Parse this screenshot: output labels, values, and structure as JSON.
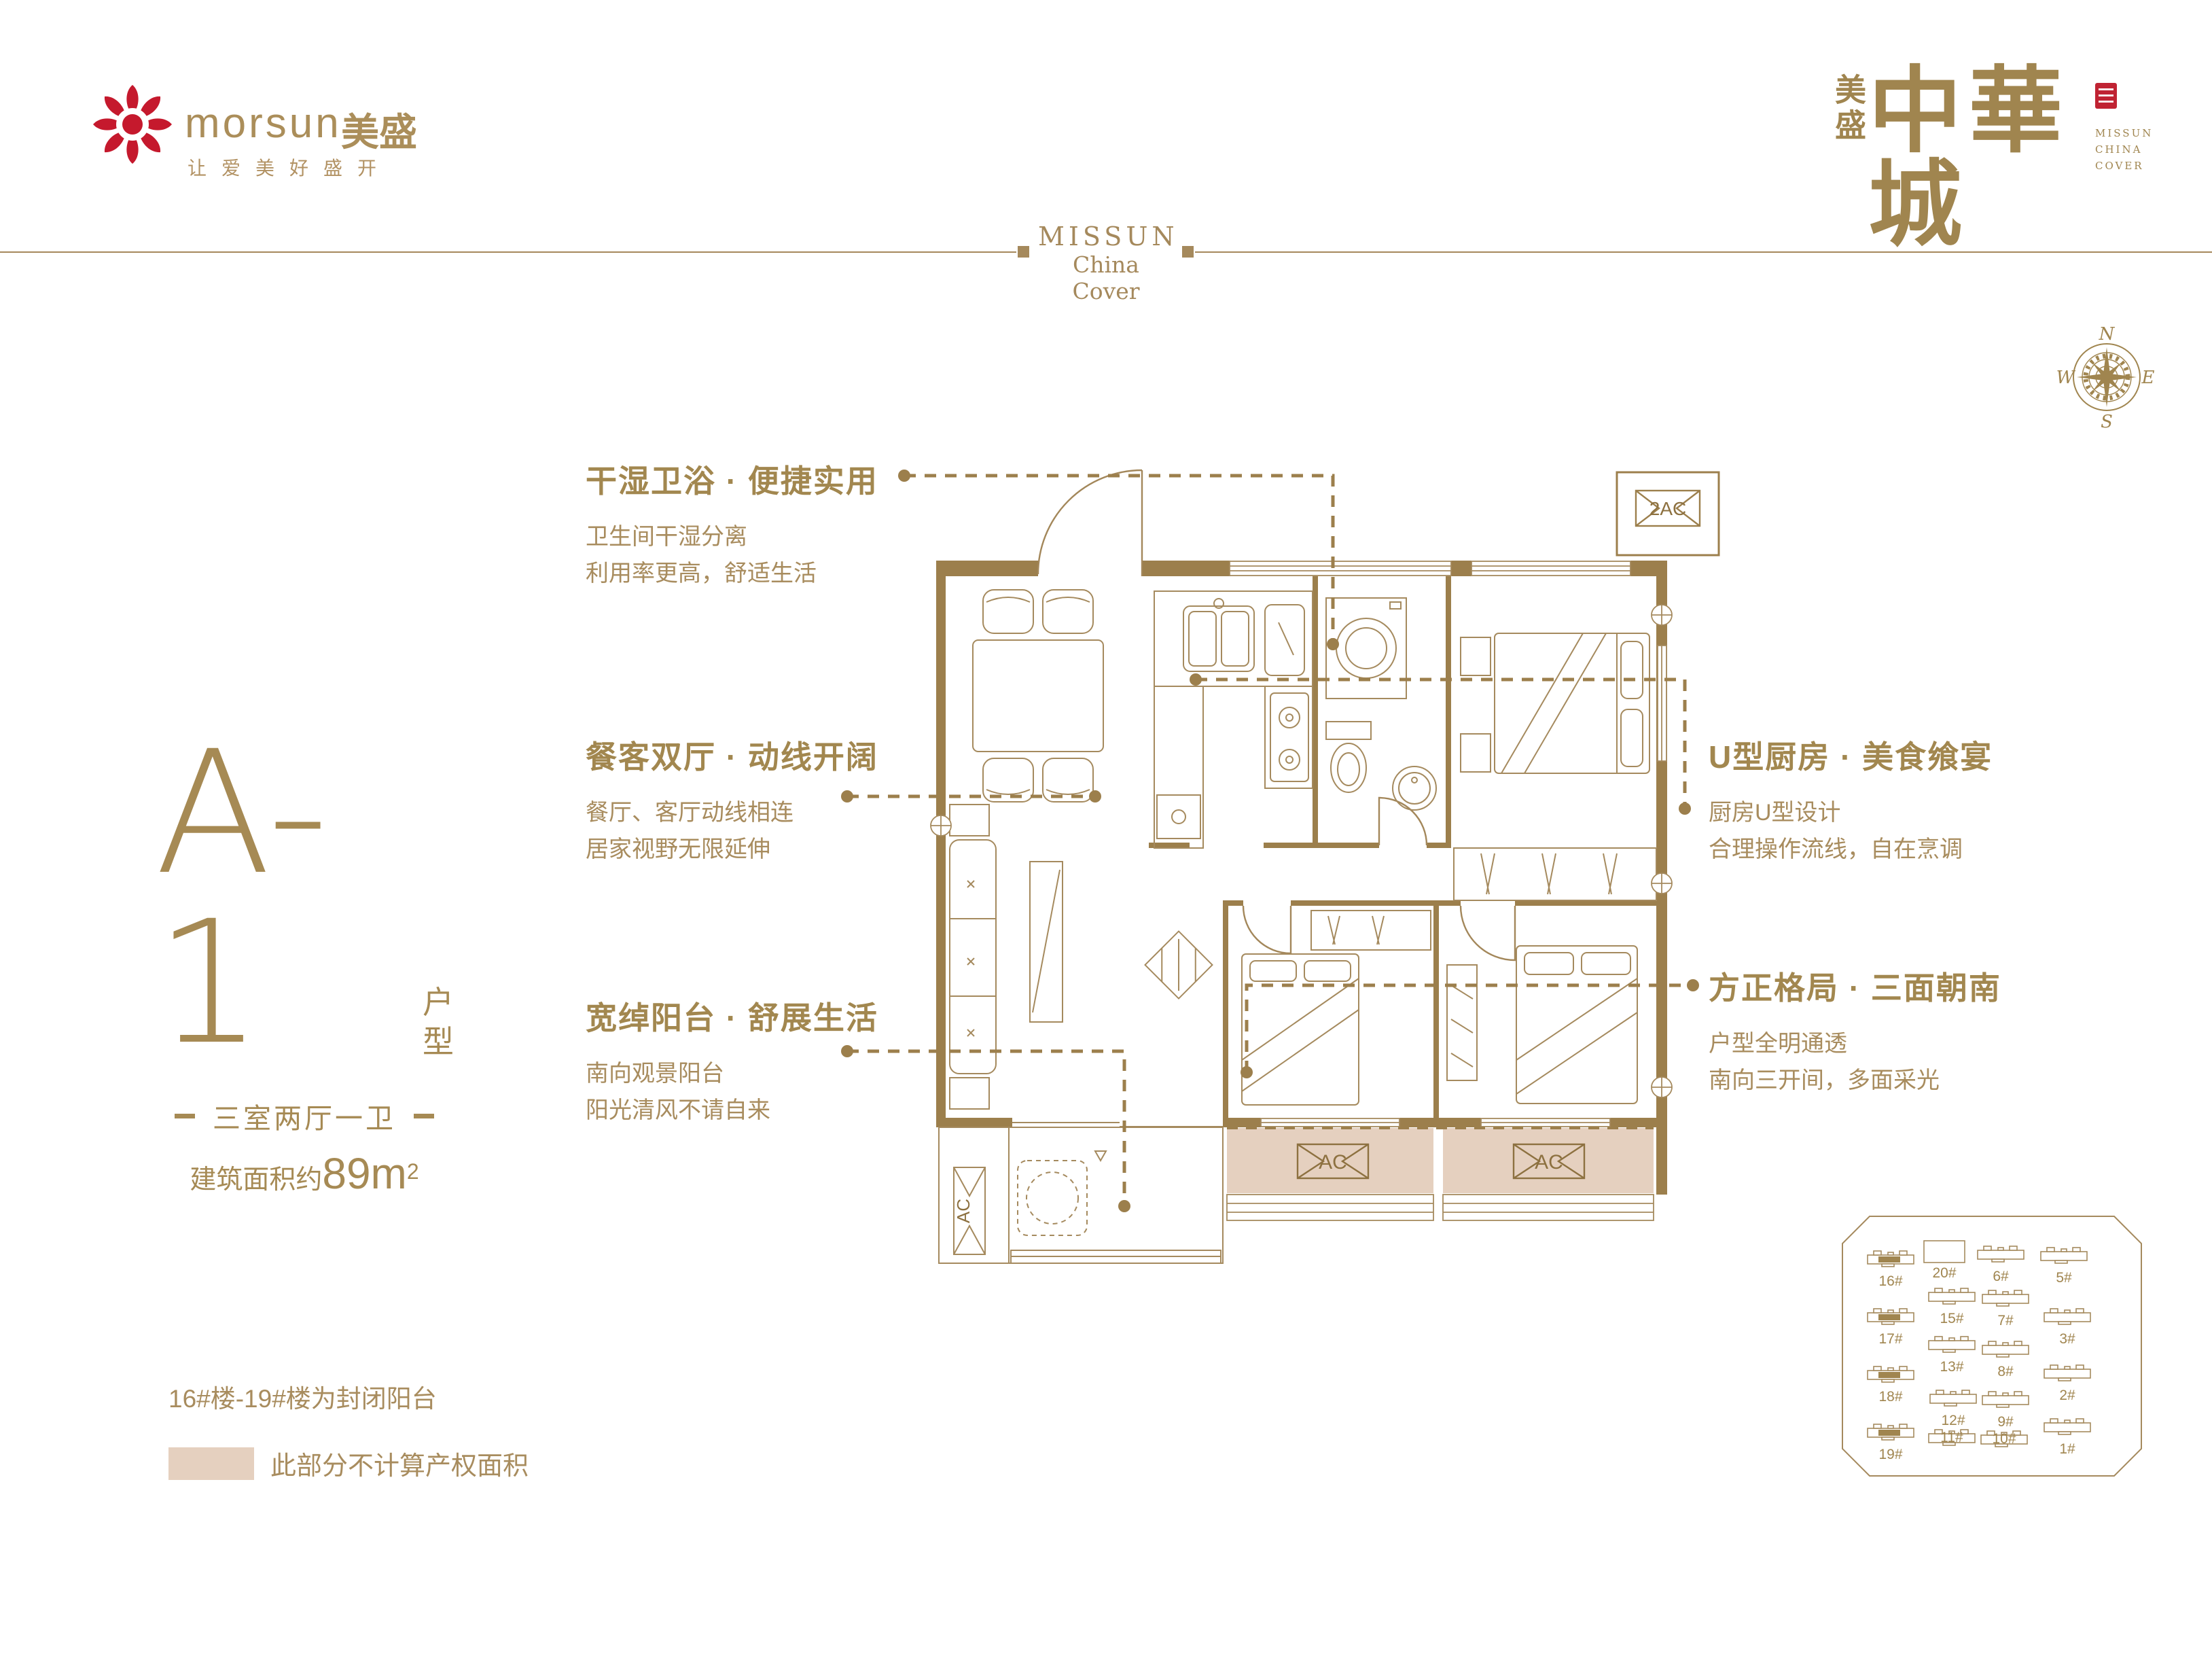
{
  "brand": {
    "logo_en": "morsun",
    "logo_cn": "美盛",
    "tagline": "让爱美好盛开",
    "red": "#c5192d",
    "gold": "#a0854f"
  },
  "project": {
    "name_prefix": "美盛",
    "name_main": "中華城",
    "sub_lines": {
      "l1": "MISSUN",
      "l2": "CHINA",
      "l3": "COVER"
    }
  },
  "divider": {
    "title": "MISSUN",
    "subtitle": "China Cover"
  },
  "unit": {
    "code": "A-1",
    "suffix_top": "户",
    "suffix_bottom": "型",
    "layout": "三室两厅一卫",
    "area_label": "建筑面积约",
    "area_value": "89m",
    "area_sup": "2"
  },
  "annotations": [
    {
      "title": "干湿卫浴 · 便捷实用",
      "line1": "卫生间干湿分离",
      "line2": "利用率更高，舒适生活"
    },
    {
      "title": "餐客双厅 · 动线开阔",
      "line1": "餐厅、客厅动线相连",
      "line2": "居家视野无限延伸"
    },
    {
      "title": "宽绰阳台 · 舒展生活",
      "line1": "南向观景阳台",
      "line2": "阳光清风不请自来"
    },
    {
      "title": "U型厨房 · 美食飨宴",
      "line1": "厨房U型设计",
      "line2": "合理操作流线，自在烹调"
    },
    {
      "title": "方正格局 · 三面朝南",
      "line1": "户型全明通透",
      "line2": "南向三开间，多面采光"
    }
  ],
  "notes": {
    "note1": "16#楼-19#楼为封闭阳台",
    "legend_label": "此部分不计算产权面积",
    "legend_color": "#e5d0bf"
  },
  "floor_plan": {
    "labels": {
      "ac": "AC",
      "ac2": "2AC"
    }
  },
  "compass": {
    "n": "N",
    "e": "E",
    "s": "S",
    "w": "W"
  },
  "site_plan": {
    "buildings": [
      {
        "label": "16#"
      },
      {
        "label": "20#"
      },
      {
        "label": "6#"
      },
      {
        "label": "5#"
      },
      {
        "label": "17#"
      },
      {
        "label": "15#"
      },
      {
        "label": "7#"
      },
      {
        "label": "3#"
      },
      {
        "label": "13#"
      },
      {
        "label": "8#"
      },
      {
        "label": "2#"
      },
      {
        "label": "18#"
      },
      {
        "label": "12#"
      },
      {
        "label": "9#"
      },
      {
        "label": "19#"
      },
      {
        "label": "11#"
      },
      {
        "label": "10#"
      },
      {
        "label": "1#"
      }
    ]
  }
}
